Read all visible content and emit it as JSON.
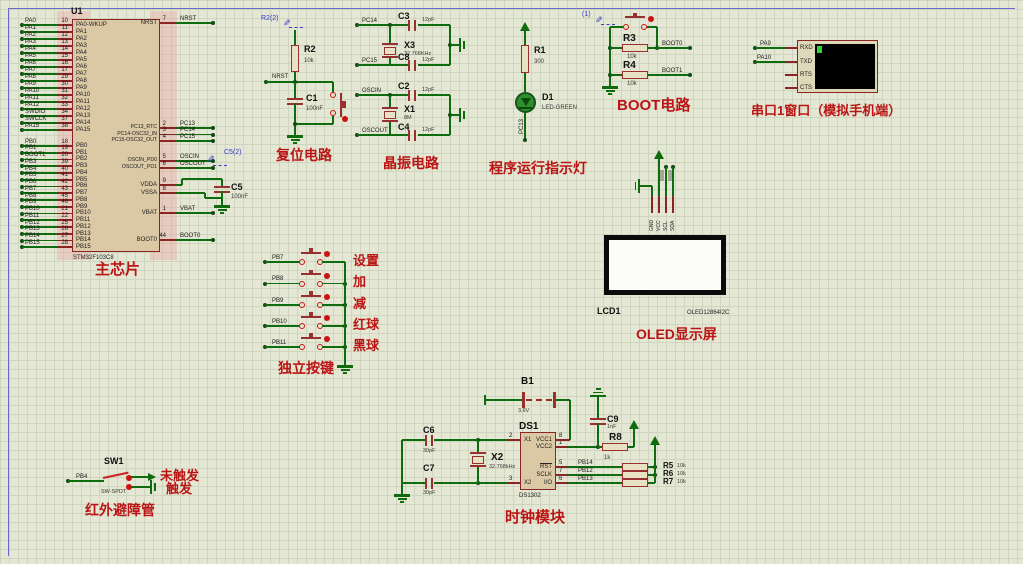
{
  "colors": {
    "background": "#e4e7d3",
    "grid": "#cfd5bf",
    "wire_green": "#0e6b0e",
    "component_maroon": "#993030",
    "chip_fill": "#dbc8a5",
    "chinese_red": "#bb1414",
    "blue_annotation": "#3a3ac8",
    "screen_black": "#000000",
    "led_green": "#2f8f2f",
    "sheet_border": "#6a6ac8",
    "sim_red_dot": "#cc1212"
  },
  "main_chip": {
    "ref": "U1",
    "part": "STM32F103C8",
    "caption": "主芯片",
    "left_pins": [
      {
        "name": "PA0-WKUP",
        "num": "10",
        "net": "PA0"
      },
      {
        "name": "PA1",
        "num": "11",
        "net": "PA1"
      },
      {
        "name": "PA2",
        "num": "12",
        "net": "PA2"
      },
      {
        "name": "PA3",
        "num": "13",
        "net": "PA3"
      },
      {
        "name": "PA4",
        "num": "14",
        "net": "PA4"
      },
      {
        "name": "PA5",
        "num": "15",
        "net": "PA5"
      },
      {
        "name": "PA6",
        "num": "16",
        "net": "PA6"
      },
      {
        "name": "PA7",
        "num": "17",
        "net": "PA7"
      },
      {
        "name": "PA8",
        "num": "29",
        "net": "PA8"
      },
      {
        "name": "PA9",
        "num": "30",
        "net": "PA9"
      },
      {
        "name": "PA10",
        "num": "31",
        "net": "PA10"
      },
      {
        "name": "PA11",
        "num": "32",
        "net": "PA11"
      },
      {
        "name": "PA12",
        "num": "33",
        "net": "PA12"
      },
      {
        "name": "PA13",
        "num": "34",
        "net": "SWDIO"
      },
      {
        "name": "PA14",
        "num": "37",
        "net": "SWCLK"
      },
      {
        "name": "PA15",
        "num": "38",
        "net": "PA15"
      },
      {
        "name": "PB0",
        "num": "18",
        "net": "PB0"
      },
      {
        "name": "PB1",
        "num": "19",
        "net": "PB1"
      },
      {
        "name": "PB2",
        "num": "20",
        "net": "BOOT1"
      },
      {
        "name": "PB3",
        "num": "39",
        "net": "PB3"
      },
      {
        "name": "PB4",
        "num": "40",
        "net": "PB4"
      },
      {
        "name": "PB5",
        "num": "41",
        "net": "PB5"
      },
      {
        "name": "PB6",
        "num": "42",
        "net": "PB6"
      },
      {
        "name": "PB7",
        "num": "43",
        "net": "PB7"
      },
      {
        "name": "PB8",
        "num": "45",
        "net": "PB8"
      },
      {
        "name": "PB9",
        "num": "46",
        "net": "PB9"
      },
      {
        "name": "PB10",
        "num": "21",
        "net": "PB10"
      },
      {
        "name": "PB11",
        "num": "22",
        "net": "PB11"
      },
      {
        "name": "PB12",
        "num": "25",
        "net": "PB12"
      },
      {
        "name": "PB13",
        "num": "26",
        "net": "PB13"
      },
      {
        "name": "PB14",
        "num": "27",
        "net": "PB14"
      },
      {
        "name": "PB15",
        "num": "28",
        "net": "PB15"
      }
    ],
    "right_pins": [
      {
        "name": "NRST",
        "num": "7",
        "net": "NRST"
      },
      {
        "name": "PC13_RTC",
        "num": "2",
        "net": "PC13"
      },
      {
        "name": "PC14-OSC32_IN",
        "num": "3",
        "net": "PC14"
      },
      {
        "name": "PC15-OSC32_OUT",
        "num": "4",
        "net": "PC15"
      },
      {
        "name": "OSCIN_PD0",
        "num": "5",
        "net": "OSCIN"
      },
      {
        "name": "OSCOUT_PD1",
        "num": "6",
        "net": "OSCOUT"
      },
      {
        "name": "VDDA",
        "num": "9",
        "net": ""
      },
      {
        "name": "VSSA",
        "num": "8",
        "net": ""
      },
      {
        "name": "VBAT",
        "num": "1",
        "net": "VBAT"
      },
      {
        "name": "BOOT0",
        "num": "44",
        "net": "BOOT0"
      }
    ],
    "decoupling_cap": {
      "ref": "C5",
      "value": "100nF"
    },
    "blue_label": "C5(2)"
  },
  "reset_circuit": {
    "caption": "复位电路",
    "blue_label": "R2(2)",
    "resistor": {
      "ref": "R2",
      "value": "10k"
    },
    "cap": {
      "ref": "C1",
      "value": "100nF"
    },
    "net": "NRST"
  },
  "crystal_circuit": {
    "caption": "晶振电路",
    "groups": [
      {
        "top_net": "PC14",
        "bottom_net": "PC15",
        "crystal": {
          "ref": "X3",
          "value": "32.768KHz"
        },
        "top_cap": {
          "ref": "C3",
          "value": "12pF"
        },
        "bottom_cap": {
          "ref": "C8",
          "value": "12pF"
        }
      },
      {
        "top_net": "OSCIN",
        "bottom_net": "OSCOUT",
        "crystal": {
          "ref": "X1",
          "value": "8M"
        },
        "top_cap": {
          "ref": "C2",
          "value": "12pF"
        },
        "bottom_cap": {
          "ref": "C4",
          "value": "12pF"
        }
      }
    ]
  },
  "led_circuit": {
    "caption": "程序运行指示灯",
    "resistor": {
      "ref": "R1",
      "value": "300"
    },
    "led": {
      "ref": "D1",
      "value": "LED-GREEN"
    },
    "net": "PC13"
  },
  "boot_circuit": {
    "caption": "BOOT电路",
    "blue_label": "(1)",
    "rows": [
      {
        "ref": "R3",
        "value": "10k",
        "net": "BOOT0"
      },
      {
        "ref": "R4",
        "value": "10k",
        "net": "BOOT1"
      }
    ]
  },
  "serial_terminal": {
    "caption": "串口1窗口（模拟手机端）",
    "pins": [
      "RXD",
      "TXD",
      "RTS",
      "CTS"
    ],
    "nets": [
      "PA9",
      "PA10"
    ]
  },
  "oled": {
    "ref": "LCD1",
    "part": "OLED12864I2C",
    "caption": "OLED显示屏",
    "pins": [
      "GND",
      "VCC",
      "SCL",
      "SDA"
    ]
  },
  "keys": {
    "caption": "独立按键",
    "rows": [
      {
        "net": "PB7",
        "label": "设置"
      },
      {
        "net": "PB8",
        "label": "加"
      },
      {
        "net": "PB9",
        "label": "减"
      },
      {
        "net": "PB10",
        "label": "红球"
      },
      {
        "net": "PB11",
        "label": "黑球"
      }
    ]
  },
  "ir_sensor": {
    "caption": "红外避障管",
    "ref": "SW1",
    "part": "SW-SPDT",
    "net": "PB4",
    "states": [
      "未触发",
      "触发"
    ]
  },
  "clock_module": {
    "caption": "时钟模块",
    "battery": {
      "ref": "B1",
      "value": "3.6V"
    },
    "chip": {
      "ref": "DS1",
      "part": "DS1302",
      "left_pins": [
        {
          "name": "X1",
          "num": "2"
        },
        {
          "name": "X2",
          "num": "3"
        }
      ],
      "right_pins": [
        {
          "name": "VCC1",
          "num": "8"
        },
        {
          "name": "VCC2",
          "num": "1"
        },
        {
          "name": "RST",
          "num": "5"
        },
        {
          "name": "SCLK",
          "num": "7"
        },
        {
          "name": "I/O",
          "num": "6"
        }
      ]
    },
    "crystal": {
      "ref": "X2",
      "value": "32.768kHz"
    },
    "cap_left_top": {
      "ref": "C6",
      "value": "30pF"
    },
    "cap_left_bottom": {
      "ref": "C7",
      "value": "30pF"
    },
    "cap_right": {
      "ref": "C9",
      "value": "1nF"
    },
    "series_res": {
      "ref": "R8",
      "value": "1k"
    },
    "pullups": [
      {
        "ref": "R5",
        "value": "10k",
        "net": "PB14"
      },
      {
        "ref": "R6",
        "value": "10k",
        "net": "PB12"
      },
      {
        "ref": "R7",
        "value": "10k",
        "net": "PB13"
      }
    ]
  }
}
